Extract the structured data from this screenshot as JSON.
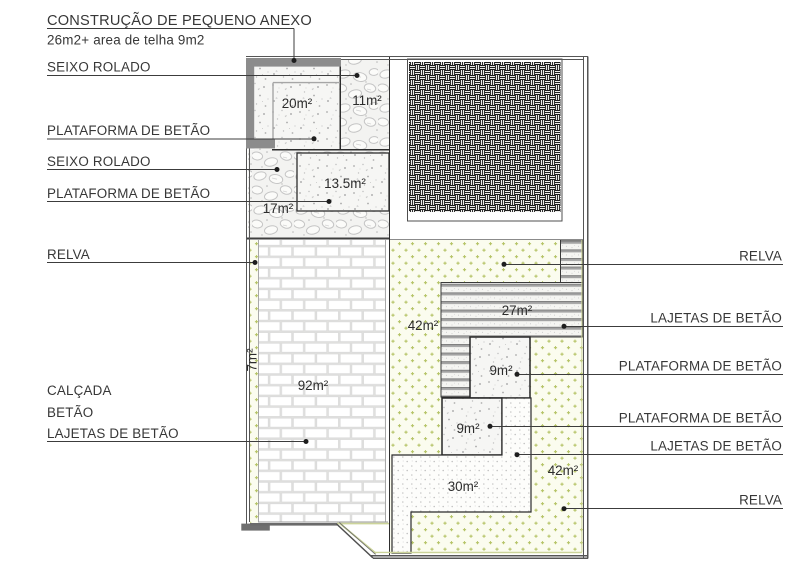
{
  "drawing": {
    "title": "CONSTRUÇÃO DE PEQUENO ANEXO",
    "subtitle": "26m2+ area de telha 9m2",
    "left_labels": {
      "seixo1": "SEIXO ROLADO",
      "plataforma1": "PLATAFORMA DE BETÃO",
      "seixo2": "SEIXO ROLADO",
      "plataforma2": "PLATAFORMA DE BETÃO",
      "relva": "RELVA",
      "calcada": "CALÇADA",
      "betao": "BETÃO",
      "lajetas": "LAJETAS DE BETÃO"
    },
    "right_labels": {
      "relva1": "RELVA",
      "lajetas1": "LAJETAS DE BETÃO",
      "plataforma1": "PLATAFORMA DE BETÃO",
      "plataforma2": "PLATAFORMA DE BETÃO",
      "lajetas2": "LAJETAS DE BETÃO",
      "relva2": "RELVA"
    },
    "areas": {
      "a20": "20m²",
      "a11": "11m²",
      "a13_5": "13.5m²",
      "a17": "17m²",
      "a7": "7m²",
      "a92": "92m²",
      "a42_upper": "42m²",
      "a27": "27m²",
      "a9_upper": "9m²",
      "a9_lower": "9m²",
      "a30": "30m²",
      "a42_lower": "42m²"
    },
    "colors": {
      "label_text": "#373737",
      "leader_line": "#3c3c3c",
      "boundary": "#565656",
      "wall_gray": "#8c8c8c",
      "grass_mark": "#b6c468",
      "grass_bg": "#fbfcef",
      "boundary_accent": "#ccd49a",
      "roof_hatch": "#1c1c1c",
      "stripe_gray": "#a3a3a3"
    }
  }
}
